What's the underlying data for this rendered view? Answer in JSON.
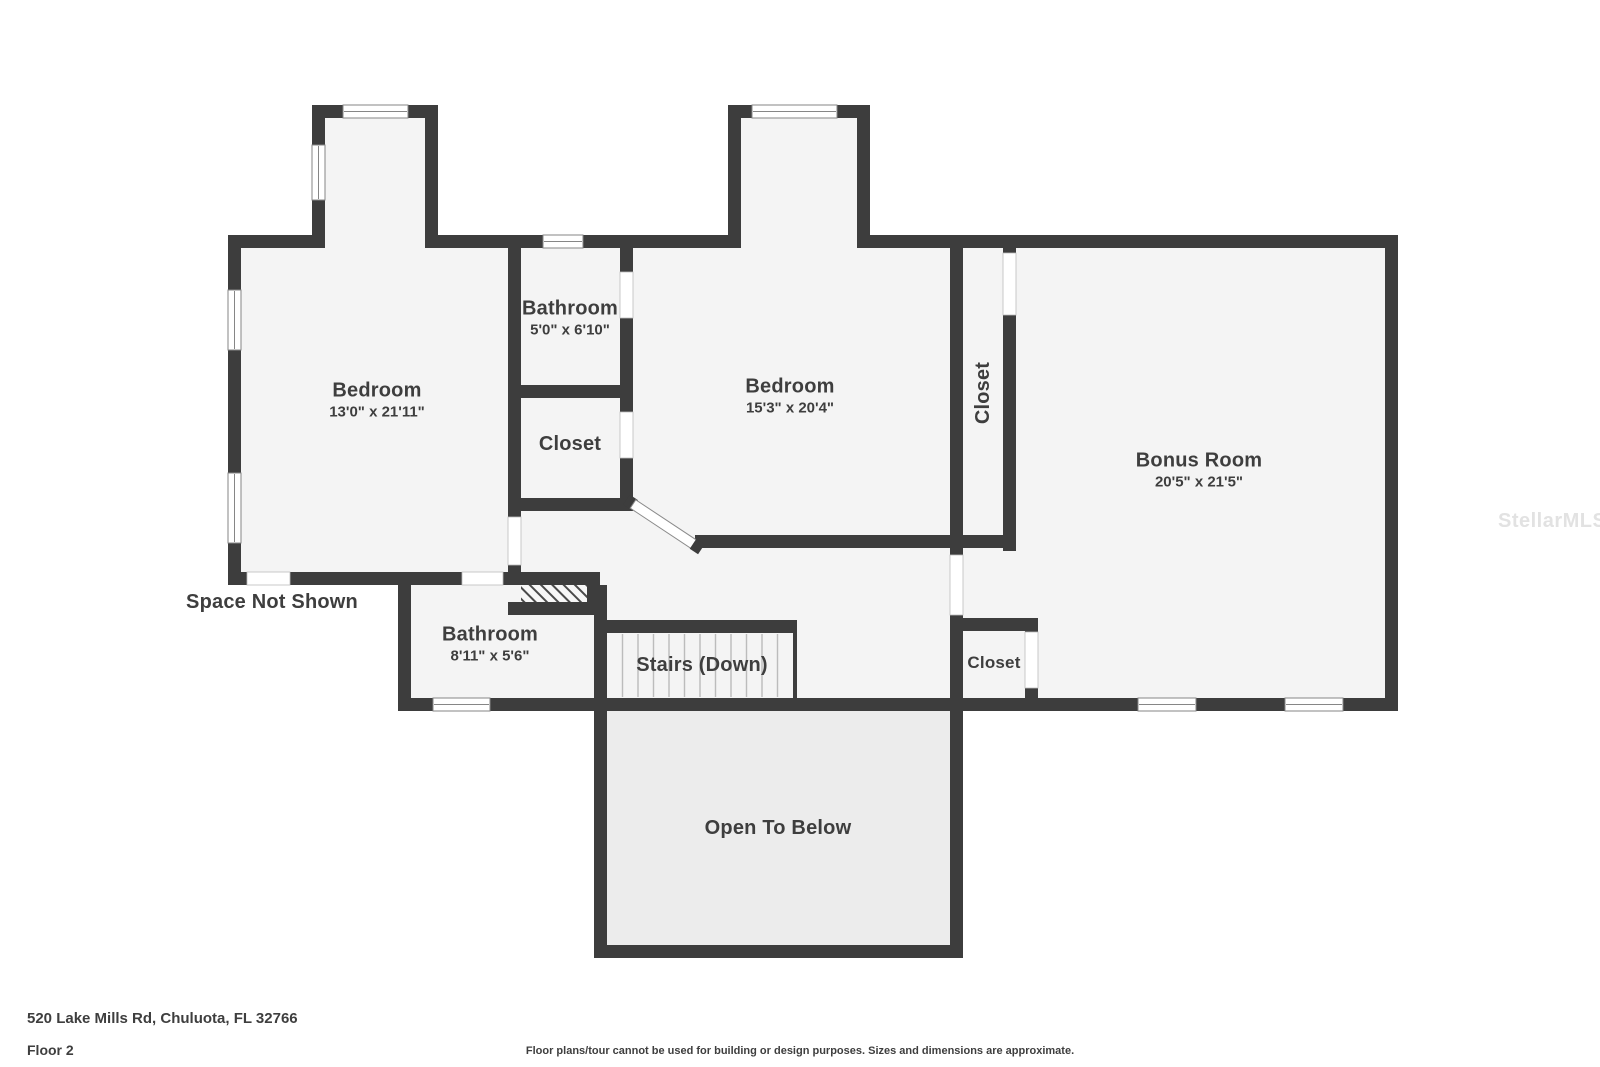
{
  "plan": {
    "watermark": "StellarMLS",
    "colors": {
      "wall": "#3d3d3d",
      "floor": "#f4f4f4",
      "open_floor": "#ececec",
      "background": "#ffffff"
    },
    "rooms": {
      "bedroom_left": {
        "name": "Bedroom",
        "dims": "13'0\" x 21'11\""
      },
      "bathroom_top": {
        "name": "Bathroom",
        "dims": "5'0\" x 6'10\""
      },
      "closet_top": {
        "name": "Closet"
      },
      "bedroom_middle": {
        "name": "Bedroom",
        "dims": "15'3\" x 20'4\""
      },
      "closet_tall": {
        "name": "Closet"
      },
      "bonus_room": {
        "name": "Bonus Room",
        "dims": "20'5\" x 21'5\""
      },
      "bathroom_bottom": {
        "name": "Bathroom",
        "dims": "8'11\" x 5'6\""
      },
      "stairs": {
        "name": "Stairs (Down)"
      },
      "closet_bottom": {
        "name": "Closet"
      },
      "open_to_below": {
        "name": "Open To Below"
      },
      "space_not_shown": {
        "name": "Space Not Shown"
      }
    }
  },
  "footer": {
    "address": "520 Lake Mills Rd, Chuluota, FL 32766",
    "floor_label": "Floor 2",
    "disclaimer": "Floor plans/tour cannot be used for building or design purposes. Sizes and dimensions are approximate."
  }
}
